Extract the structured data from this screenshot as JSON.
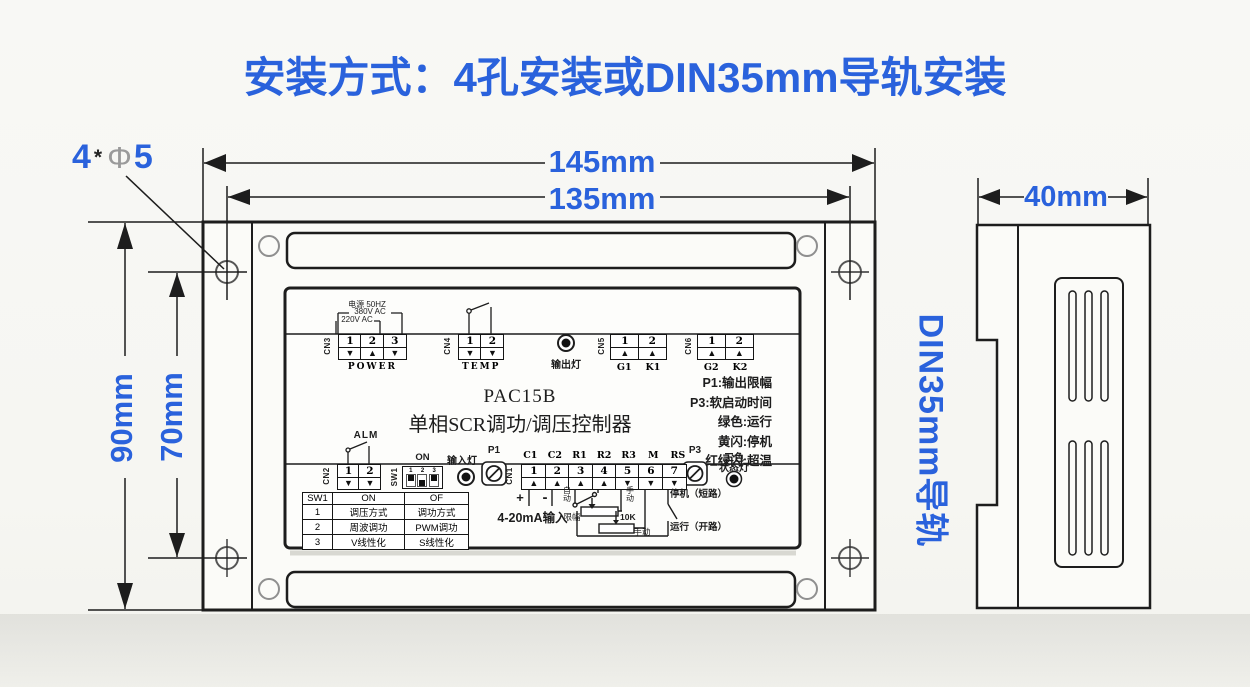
{
  "title": "安装方式：4孔安装或DIN35mm导轨安装",
  "colors": {
    "accent_blue": "#2a62dc",
    "line_black": "#1d1d1d",
    "hole_gray": "#9a9a9a"
  },
  "front_view": {
    "hole_note": {
      "count": "4",
      "star": "*",
      "phi": "Φ",
      "diameter": "5"
    },
    "dim_outer_width": "145mm",
    "dim_hole_width": "135mm",
    "dim_outer_height": "90mm",
    "dim_hole_height": "70mm"
  },
  "panel": {
    "model": "PAC15B",
    "model_desc": "单相SCR调功/调压控制器",
    "power_notes": [
      "电源 50HZ",
      "380V AC",
      "220V AC"
    ],
    "cn3": {
      "id": "CN3",
      "cap": "POWER",
      "pins": [
        {
          "n": "1",
          "arrow": "▼"
        },
        {
          "n": "2",
          "arrow": "▲"
        },
        {
          "n": "3",
          "arrow": "▼"
        }
      ]
    },
    "cn4": {
      "id": "CN4",
      "cap": "TEMP",
      "pins": [
        {
          "n": "1",
          "arrow": "▼"
        },
        {
          "n": "2",
          "arrow": "▼"
        }
      ]
    },
    "output_led_label": "输出灯",
    "cn5": {
      "id": "CN5",
      "pins": [
        {
          "n": "1",
          "arrow": "▲",
          "tag": "G1"
        },
        {
          "n": "2",
          "arrow": "▲",
          "tag": "K1"
        }
      ]
    },
    "cn6": {
      "id": "CN6",
      "pins": [
        {
          "n": "1",
          "arrow": "▲",
          "tag": "G2"
        },
        {
          "n": "2",
          "arrow": "▲",
          "tag": "K2"
        }
      ]
    },
    "legend": [
      "P1:输出限幅",
      "P3:软启动时间",
      "绿色:运行",
      "黄闪:停机",
      "红绿闪:超温"
    ],
    "alm_label": "ALM",
    "cn2": {
      "id": "CN2",
      "pins": [
        {
          "n": "1",
          "arrow": "▼"
        },
        {
          "n": "2",
          "arrow": "▼"
        }
      ]
    },
    "sw1": {
      "id": "SW1",
      "on_label": "ON",
      "switches": [
        {
          "num": "1",
          "state": "up"
        },
        {
          "num": "2",
          "state": "down"
        },
        {
          "num": "3",
          "state": "up"
        }
      ]
    },
    "input_led_label": "输入灯",
    "p1_label": "P1",
    "cn1": {
      "id": "CN1",
      "pins": [
        {
          "n": "1",
          "arrow": "▲",
          "tag": "C1"
        },
        {
          "n": "2",
          "arrow": "▲",
          "tag": "C2"
        },
        {
          "n": "3",
          "arrow": "▲",
          "tag": "R1"
        },
        {
          "n": "4",
          "arrow": "▲",
          "tag": "R2"
        },
        {
          "n": "5",
          "arrow": "▼",
          "tag": "R3"
        },
        {
          "n": "6",
          "arrow": "▼",
          "tag": "M"
        },
        {
          "n": "7",
          "arrow": "▼",
          "tag": "RS"
        }
      ]
    },
    "p3_label": "P3",
    "status_led_label_line1": "三色",
    "status_led_label_line2": "状态灯",
    "sw_table": {
      "headers": [
        "SW1",
        "ON",
        "OF"
      ],
      "rows": [
        [
          "1",
          "调压方式",
          "调功方式"
        ],
        [
          "2",
          "周波调功",
          "PWM调功"
        ],
        [
          "3",
          "V线性化",
          "S线性化"
        ]
      ]
    },
    "analog": {
      "plus": "+",
      "minus": "-",
      "label": "4-20mA输入"
    },
    "wiring": {
      "auto": "自动",
      "manual_top": "手动",
      "limit": "限幅",
      "resistor": "10K",
      "manual_bottom": "手动",
      "stop_note": "停机（短路）",
      "run_note": "运行（开路）"
    }
  },
  "side_view": {
    "dim_width": "40mm",
    "rail_label": "DIN35mm导轨"
  }
}
